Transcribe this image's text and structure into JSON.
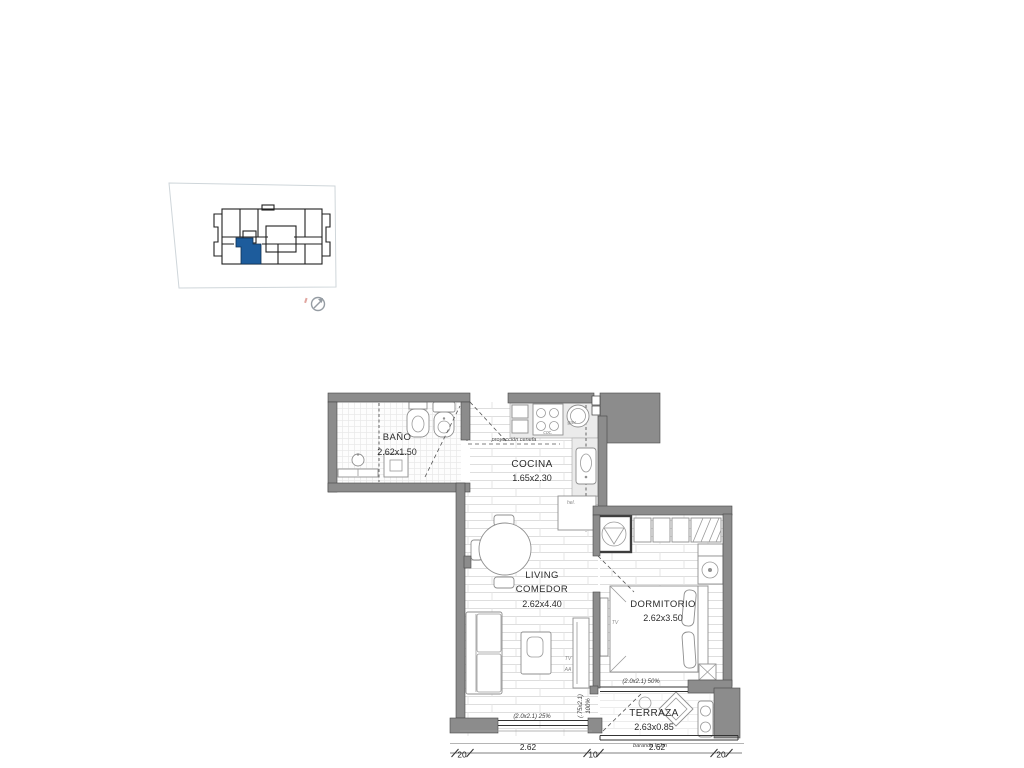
{
  "colors": {
    "unit_highlight": "#1d5c9c",
    "walls": "#8c8c8c",
    "background": "#ffffff"
  },
  "rooms": {
    "bano": {
      "name": "BAÑO",
      "dims": "2.62x1.50"
    },
    "cocina": {
      "name": "COCINA",
      "dims": "1.65x2.30"
    },
    "living": {
      "line1": "LIVING",
      "line2": "COMEDOR",
      "dims": "2.62x4.40"
    },
    "dormitorio": {
      "name": "DORMITORIO",
      "dims": "2.62x3.50"
    },
    "terraza": {
      "name": "TERRAZA",
      "dims": "2.63x0.85"
    }
  },
  "annotations": {
    "proyeccion_cenefa": "proyección cenefa",
    "window_living": "(2.0x2.1) 25%",
    "window_dorm": "(2.0x2.1) 50%",
    "door_terraza_size": "(.75x2.1)",
    "door_terraza_pct": "100%",
    "baranda": "baranda h:1m",
    "tv_living": "TV",
    "aa_living": "AA",
    "tv_dorm": "TV",
    "kitchen_stove": "coc.",
    "kitchen_sink": "gav.",
    "kitchen_fridge": "hel."
  },
  "dimension_strip": {
    "values": [
      "20",
      "2.62",
      "10",
      "2.62",
      "20"
    ]
  }
}
